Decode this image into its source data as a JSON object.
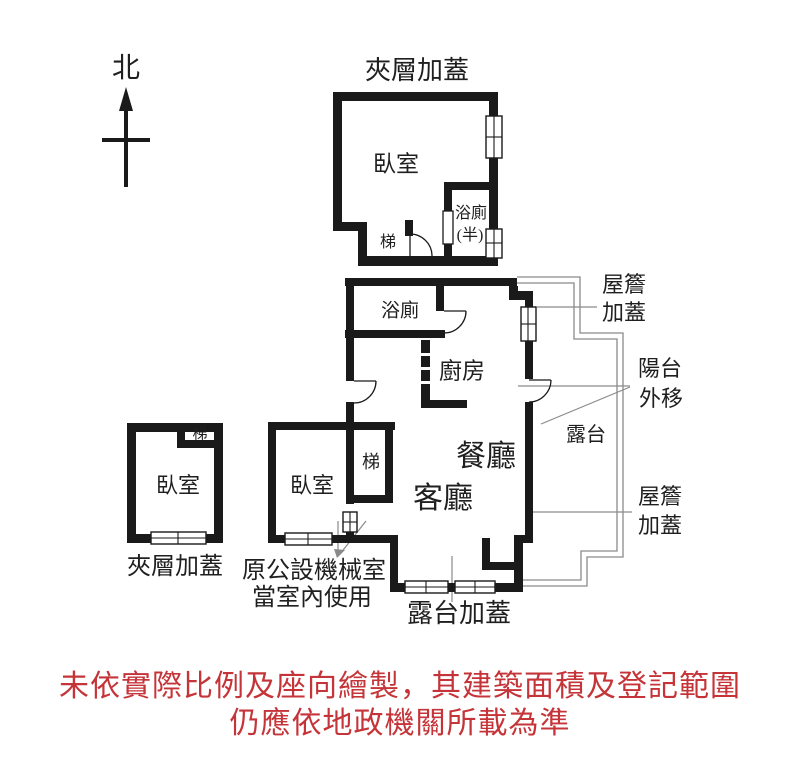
{
  "north": {
    "label": "北"
  },
  "labels": {
    "mezzanine_top": "夾層加蓋",
    "upper_bedroom": "臥室",
    "upper_stairs": "梯",
    "upper_bath_line1": "浴廁",
    "upper_bath_line2": "(半)",
    "main_bath": "浴廁",
    "kitchen": "廚房",
    "dining": "餐廳",
    "living": "客廳",
    "main_stairs": "梯",
    "terrace": "露台",
    "balcony_line1": "陽台",
    "balcony_line2": "外移",
    "eave_top_line1": "屋簷",
    "eave_top_line2": "加蓋",
    "eave_bottom_line1": "屋簷",
    "eave_bottom_line2": "加蓋",
    "left_bedroom": "臥室",
    "left_bedroom_stairs": "梯",
    "mezzanine_left": "夾層加蓋",
    "mid_bedroom": "臥室",
    "machine_room_line1": "原公設機械室",
    "machine_room_line2": "當室內使用",
    "terrace_cover": "露台加蓋"
  },
  "disclaimer": {
    "line1": "未依實際比例及座向繪製，其建築面積及登記範圍",
    "line2": "仍應依地政機關所載為準",
    "color": "#c53438"
  },
  "colors": {
    "wall": "#1a1a1a",
    "thin_line": "#8a8a8a",
    "label_text": "#1f1f1f",
    "disclaimer_red": "#c53438",
    "background": "#ffffff"
  }
}
